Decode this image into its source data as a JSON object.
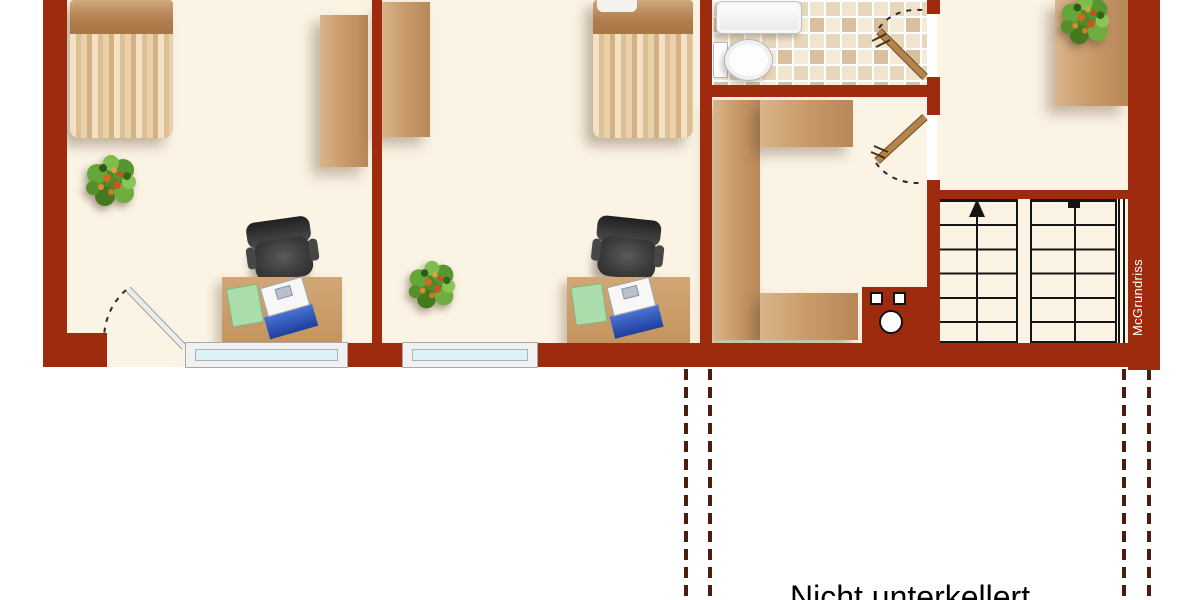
{
  "annotations": {
    "basement_note": "Nicht unterkellert",
    "watermark": "McGrundriss"
  },
  "colors": {
    "wall": "#9E2B0E",
    "floor": "#FBF3E4",
    "wood": "#C89A68",
    "window_glass": "#DBF3F8",
    "dashed_line": "#4A1E0E",
    "stair_line": "#151515",
    "laptop_blue": "#1D3F9E",
    "desk_pad_green": "#ABDCAB",
    "chair_gray": "#3A3A3A",
    "tile_light": "#F3EAD8",
    "tile_dark": "#D9BF9C",
    "page_background": "#FFFFFF"
  },
  "floorplan": {
    "rooms": [
      {
        "id": "bedroom-left",
        "furniture": [
          "bed",
          "wardrobe",
          "plant",
          "office-chair",
          "desk",
          "desk-pad",
          "laptop",
          "window",
          "door"
        ]
      },
      {
        "id": "bedroom-middle",
        "furniture": [
          "wardrobe",
          "bed",
          "plant",
          "office-chair",
          "desk",
          "desk-pad",
          "laptop",
          "window"
        ]
      },
      {
        "id": "bathroom",
        "furniture": [
          "tiled-floor",
          "shower-tray",
          "toilet",
          "door"
        ]
      },
      {
        "id": "hallway",
        "furniture": [
          "u-shaped-cabinet",
          "chimney-shaft",
          "door"
        ]
      },
      {
        "id": "stair-room",
        "furniture": [
          "staircase",
          "sideboard",
          "plant"
        ]
      }
    ],
    "stairs": {
      "flights": 2,
      "steps_per_flight": 6,
      "walk_line_markers": [
        "up-arrow",
        "start-square"
      ]
    },
    "doors": [
      {
        "room": "bedroom-left",
        "position": "bottom-left",
        "leaf": "light"
      },
      {
        "room": "bathroom",
        "position": "right-wall",
        "leaf": "wood"
      },
      {
        "room": "hallway",
        "position": "right-wall",
        "leaf": "wood"
      }
    ],
    "windows": 2,
    "basement_outline": "dashed projection lines below plan"
  }
}
